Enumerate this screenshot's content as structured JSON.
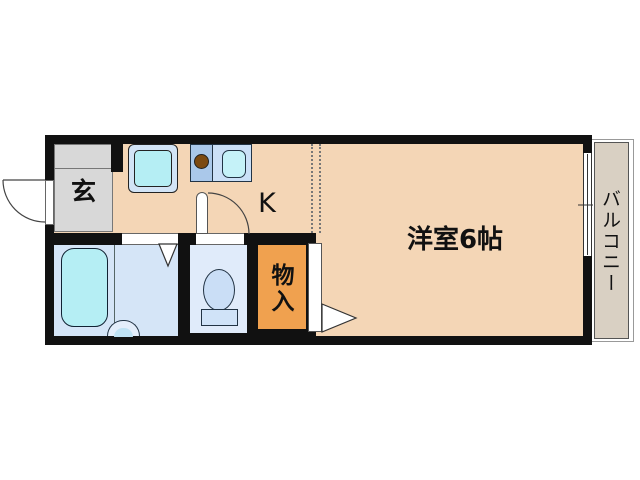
{
  "plan": {
    "rooms": {
      "genkan": {
        "label": "玄"
      },
      "kitchen": {
        "label": "K"
      },
      "western_room": {
        "label": "洋室6帖"
      },
      "closet": {
        "label": "物入"
      },
      "balcony": {
        "label": "バルコニー"
      }
    },
    "colors": {
      "wall": "#111111",
      "floor": "#f4d6b6",
      "genkan": "#d8d8d8",
      "bathroom": "#d5e5f7",
      "toilet_room": "#e0ebfa",
      "fixture_cyan": "#b5eef4",
      "fixture_blue_light": "#d2e4f6",
      "counter_left": "#aac8ea",
      "counter_right": "#cbe0f7",
      "sink": "#c5f2f8",
      "burner": "#7c4a12",
      "closet": "#f0a14f",
      "balcony_floor": "#d9d0c3"
    }
  }
}
